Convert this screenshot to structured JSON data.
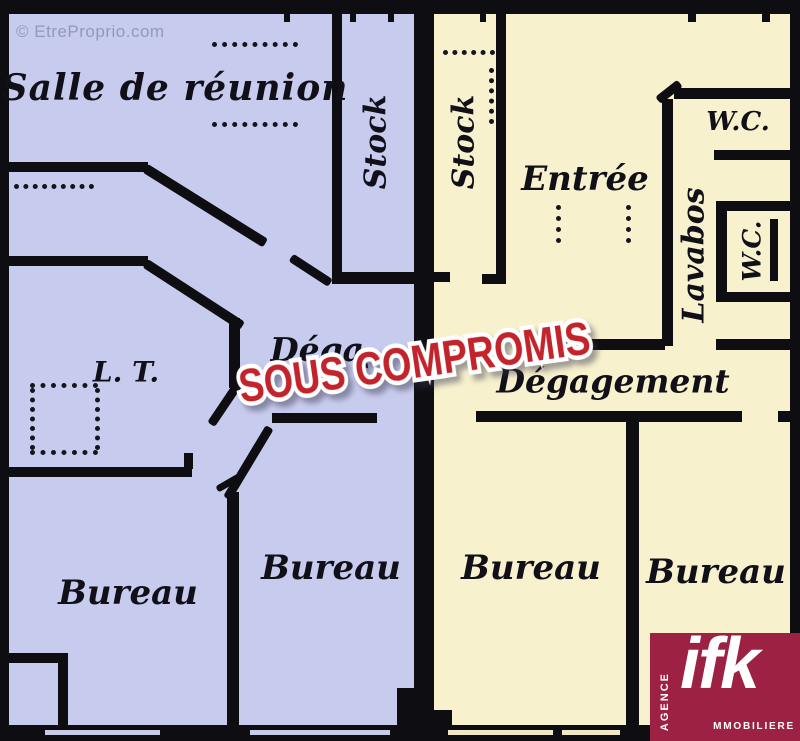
{
  "watermark": "© EtreProprio.com",
  "stamp": {
    "text": "SOUS COMPROMIS",
    "color": "#c3242b"
  },
  "logo": {
    "brand": "ifk",
    "agence": "AGENCE",
    "immobiliere": "MMOBILIERE",
    "bg": "#9c2142"
  },
  "left_unit": {
    "floor_color": "#c7cbed",
    "rooms": [
      {
        "id": "salle-de-reunion",
        "label": "Salle de réunion"
      },
      {
        "id": "stock-left",
        "label": "Stock"
      },
      {
        "id": "local-technique",
        "label": "L. T."
      },
      {
        "id": "degagement-left",
        "label": "Dégagement"
      },
      {
        "id": "bureau-1",
        "label": "Bureau"
      },
      {
        "id": "bureau-2",
        "label": "Bureau"
      }
    ]
  },
  "right_unit": {
    "floor_color": "#f8f1cd",
    "rooms": [
      {
        "id": "stock-right",
        "label": "Stock"
      },
      {
        "id": "entree",
        "label": "Entrée"
      },
      {
        "id": "wc-top",
        "label": "W.C."
      },
      {
        "id": "lavabos",
        "label": "Lavabos"
      },
      {
        "id": "wc-side",
        "label": "W.C."
      },
      {
        "id": "degagement-right",
        "label": "Dégagement"
      },
      {
        "id": "bureau-3",
        "label": "Bureau"
      },
      {
        "id": "bureau-4",
        "label": "Bureau"
      }
    ]
  }
}
